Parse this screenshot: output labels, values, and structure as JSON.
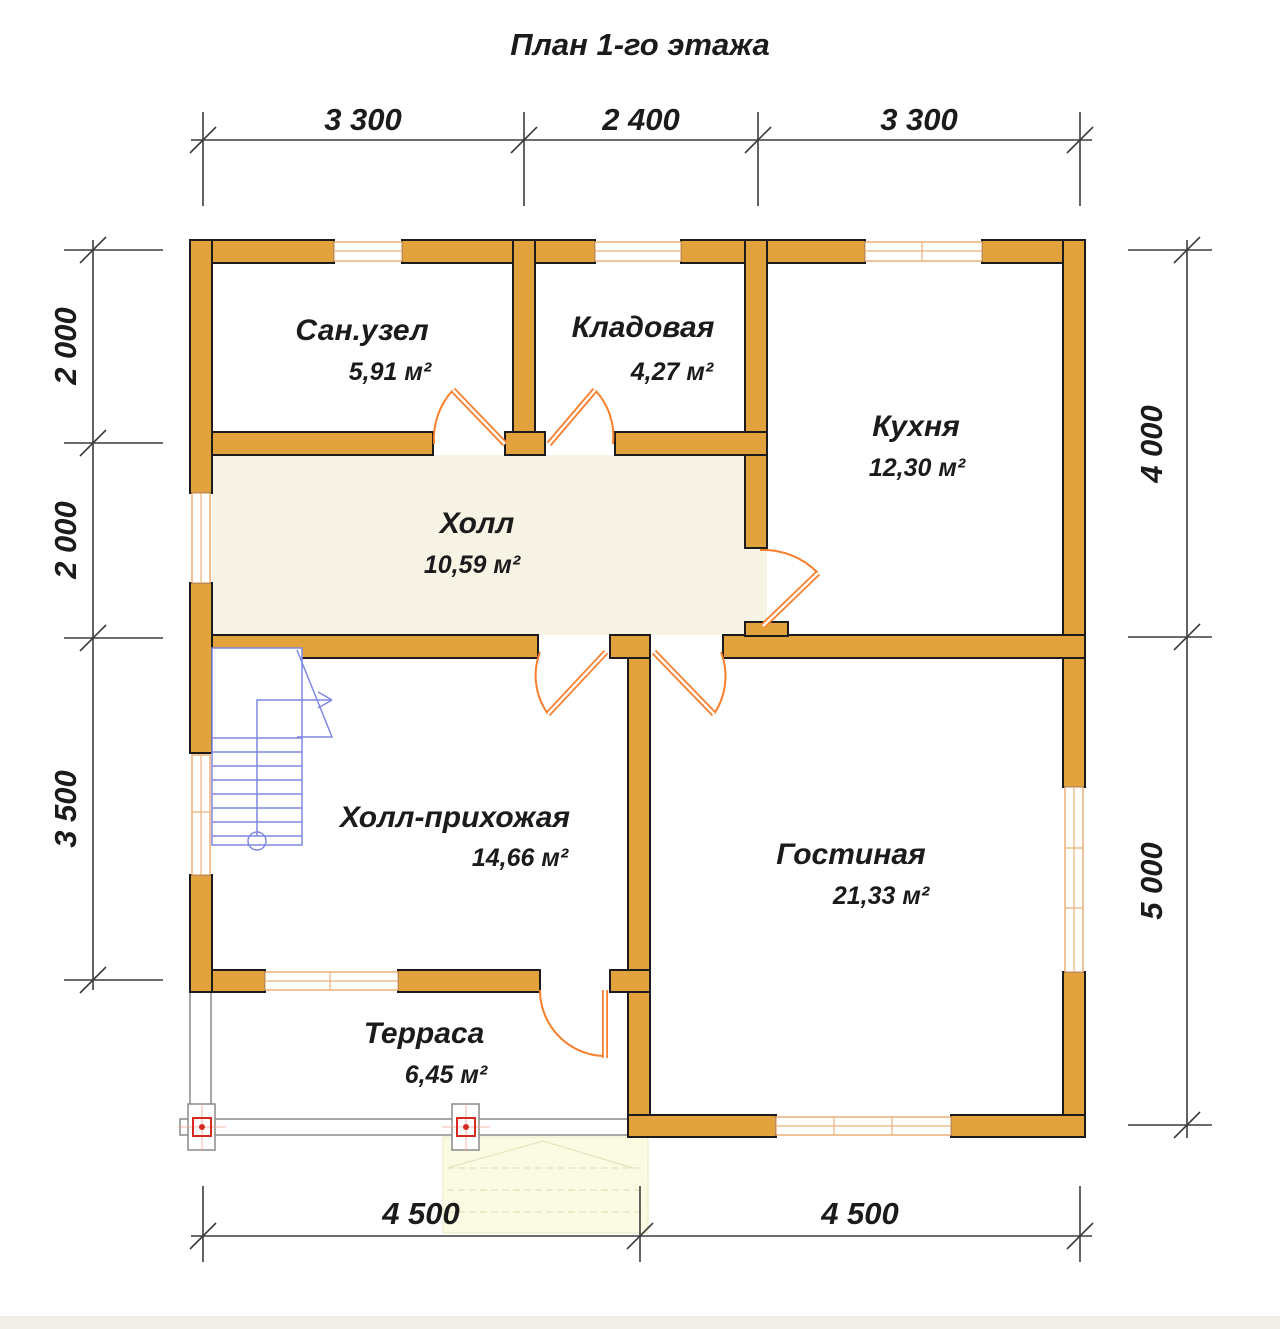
{
  "title": "План 1-го этажа",
  "rooms": [
    {
      "name": "Сан.узел",
      "area": "5,91 м²"
    },
    {
      "name": "Кладовая",
      "area": "4,27 м²"
    },
    {
      "name": "Кухня",
      "area": "12,30 м²"
    },
    {
      "name": "Холл",
      "area": "10,59 м²"
    },
    {
      "name": "Холл-прихожая",
      "area": "14,66 м²"
    },
    {
      "name": "Гостиная",
      "area": "21,33 м²"
    },
    {
      "name": "Терраса",
      "area": "6,45 м²"
    }
  ],
  "dimensions": {
    "top": [
      "3 300",
      "2 400",
      "3 300"
    ],
    "left": [
      "2 000",
      "2 000",
      "3 500"
    ],
    "right": [
      "4 000",
      "5 000"
    ],
    "bottom": [
      "4 500",
      "4 500"
    ]
  },
  "colors": {
    "wall": "#E3A33C",
    "door": "#F87E2C",
    "stairs": "#7E88E2",
    "window_frame": "#ECB077",
    "anchor_red": "#D42A20",
    "hall_floor": "#F7F4E6",
    "porch": "#FBFBE3"
  }
}
